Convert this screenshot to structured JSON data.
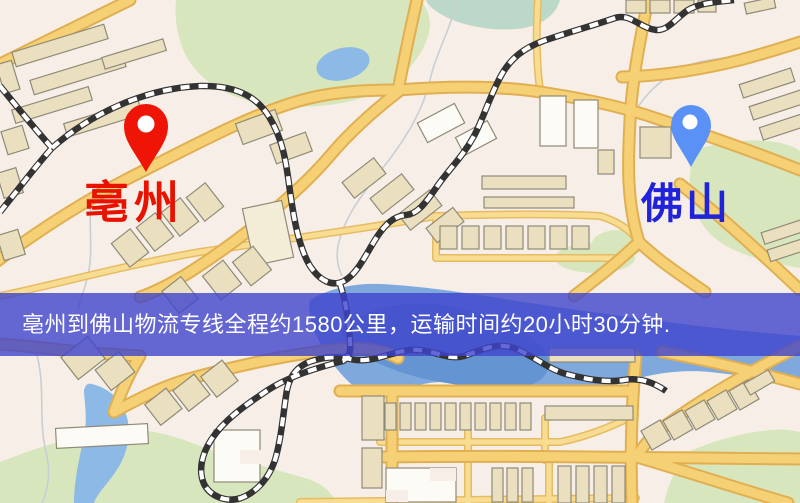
{
  "map": {
    "origin": {
      "label": "亳州",
      "pin_icon": "red-map-pin",
      "pin_color": "#ee1506",
      "label_color": "#e81200"
    },
    "destination": {
      "label": "佛山",
      "pin_icon": "blue-map-pin",
      "pin_color": "#5a91f7",
      "label_color": "#2023da"
    },
    "banner": {
      "text": "亳州到佛山物流专线全程约1580公里，运输时间约20小时30分钟.",
      "background_color": "rgba(62,68,205,0.8)",
      "text_color": "#ffffff"
    },
    "route_summary": {
      "from": "亳州",
      "to": "佛山",
      "distance_text": "约1580公里",
      "duration_text": "约20小时30分钟"
    },
    "legend_colors": {
      "road": "#f6d075",
      "park": "#d8e6bd",
      "water": "#8cb9e6",
      "building": "#eae0bf",
      "railway": "#333333",
      "background": "#f7efe7"
    }
  }
}
